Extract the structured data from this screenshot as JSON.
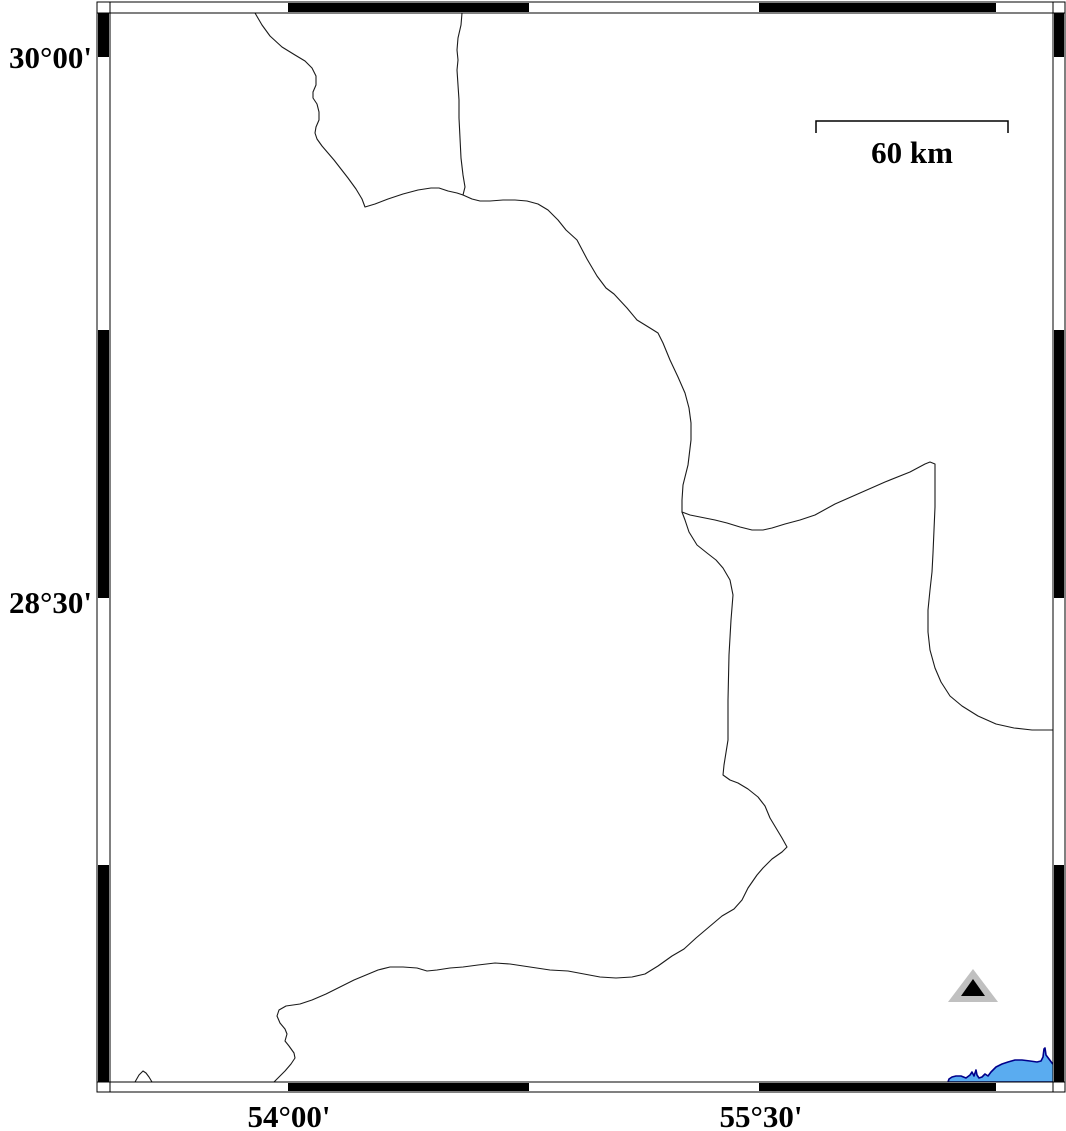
{
  "map": {
    "labels": {
      "lat": [
        {
          "text": "30°00'",
          "y_px": 57
        },
        {
          "text": "28°30'",
          "y_px": 602
        }
      ],
      "lon": [
        {
          "text": "54°00'",
          "x_px": 288
        },
        {
          "text": "55°30'",
          "x_px": 760
        }
      ]
    },
    "scalebar": {
      "label": "60 km",
      "x1": 816,
      "x2": 1008,
      "y": 121,
      "tick_drop": 12
    },
    "station_symbol": {
      "shape": "triangle",
      "outer": {
        "points": [
          [
            973,
            969
          ],
          [
            948,
            1002
          ],
          [
            998,
            1002
          ]
        ],
        "color": "#c0c0c0"
      },
      "inner": {
        "points": [
          [
            973,
            979
          ],
          [
            961,
            996
          ],
          [
            985,
            996
          ]
        ],
        "color": "#000000"
      }
    },
    "colors": {
      "boundary": "#1a1a1a",
      "lake_fill": "#5aacf0",
      "lake_stroke": "#00008b",
      "frame_black": "#000000",
      "frame_white": "#ffffff"
    },
    "frame": {
      "outer_x1": 97,
      "outer_x2": 1065,
      "outer_y1": 2,
      "outer_y2": 1092,
      "inner_x1": 110,
      "inner_x2": 1053,
      "inner_y1": 13,
      "inner_y2": 1082,
      "lon_black_segments_px": [
        [
          288,
          529
        ],
        [
          759,
          996
        ]
      ],
      "lat_black_segments_px": [
        [
          13,
          57
        ],
        [
          330,
          598
        ],
        [
          865,
          1082
        ]
      ]
    },
    "boundaries": [
      {
        "name": "northwest-zigzag-boundary",
        "points": [
          [
            255,
            13
          ],
          [
            262,
            25
          ],
          [
            270,
            36
          ],
          [
            282,
            47
          ],
          [
            295,
            55
          ],
          [
            305,
            61
          ],
          [
            312,
            68
          ],
          [
            316,
            76
          ],
          [
            316,
            85
          ],
          [
            313,
            92
          ],
          [
            313,
            98
          ],
          [
            317,
            104
          ],
          [
            319,
            112
          ],
          [
            319,
            120
          ],
          [
            316,
            127
          ],
          [
            315,
            133
          ],
          [
            317,
            139
          ],
          [
            322,
            146
          ],
          [
            328,
            153
          ],
          [
            334,
            160
          ],
          [
            341,
            169
          ],
          [
            348,
            178
          ],
          [
            356,
            189
          ],
          [
            362,
            199
          ],
          [
            365,
            207
          ],
          [
            375,
            204
          ],
          [
            388,
            199
          ],
          [
            403,
            194
          ],
          [
            418,
            190
          ],
          [
            431,
            188
          ],
          [
            439,
            188
          ],
          [
            448,
            191
          ],
          [
            457,
            193
          ],
          [
            463,
            195
          ]
        ]
      },
      {
        "name": "north-vertical-boundary",
        "points": [
          [
            462,
            13
          ],
          [
            461,
            25
          ],
          [
            458,
            38
          ],
          [
            457,
            50
          ],
          [
            458,
            60
          ],
          [
            457,
            70
          ],
          [
            458,
            85
          ],
          [
            459,
            100
          ],
          [
            459,
            118
          ],
          [
            460,
            138
          ],
          [
            461,
            158
          ],
          [
            463,
            175
          ],
          [
            465,
            187
          ],
          [
            463,
            195
          ]
        ]
      },
      {
        "name": "central-spine-boundary",
        "points": [
          [
            463,
            195
          ],
          [
            472,
            199
          ],
          [
            480,
            201
          ],
          [
            490,
            201
          ],
          [
            503,
            200
          ],
          [
            515,
            200
          ],
          [
            527,
            201
          ],
          [
            538,
            204
          ],
          [
            548,
            210
          ],
          [
            558,
            220
          ],
          [
            566,
            230
          ],
          [
            577,
            240
          ],
          [
            587,
            259
          ],
          [
            597,
            276
          ],
          [
            606,
            288
          ],
          [
            614,
            294
          ],
          [
            627,
            308
          ],
          [
            637,
            320
          ],
          [
            650,
            328
          ],
          [
            658,
            333
          ],
          [
            663,
            343
          ],
          [
            670,
            360
          ],
          [
            678,
            377
          ],
          [
            685,
            393
          ],
          [
            689,
            408
          ],
          [
            691,
            423
          ],
          [
            691,
            440
          ],
          [
            688,
            465
          ],
          [
            683,
            485
          ],
          [
            682,
            500
          ],
          [
            682,
            512
          ]
        ]
      },
      {
        "name": "east-boundary",
        "points": [
          [
            682,
            512
          ],
          [
            690,
            515
          ],
          [
            700,
            517
          ],
          [
            715,
            520
          ],
          [
            727,
            523
          ],
          [
            740,
            527
          ],
          [
            752,
            530
          ],
          [
            763,
            530
          ],
          [
            772,
            528
          ],
          [
            785,
            524
          ],
          [
            800,
            520
          ],
          [
            815,
            515
          ],
          [
            835,
            504
          ],
          [
            860,
            493
          ],
          [
            885,
            482
          ],
          [
            910,
            472
          ],
          [
            925,
            464
          ],
          [
            930,
            462
          ],
          [
            935,
            464
          ],
          [
            935,
            480
          ],
          [
            935,
            507
          ],
          [
            934,
            530
          ],
          [
            933,
            553
          ],
          [
            932,
            572
          ],
          [
            930,
            590
          ],
          [
            928,
            610
          ],
          [
            928,
            632
          ],
          [
            930,
            650
          ],
          [
            935,
            668
          ],
          [
            941,
            682
          ],
          [
            950,
            696
          ],
          [
            962,
            706
          ],
          [
            978,
            716
          ],
          [
            996,
            724
          ],
          [
            1014,
            728
          ],
          [
            1032,
            730
          ],
          [
            1045,
            730
          ],
          [
            1053,
            730
          ]
        ]
      },
      {
        "name": "south-boundary",
        "points": [
          [
            682,
            512
          ],
          [
            685,
            520
          ],
          [
            689,
            532
          ],
          [
            697,
            545
          ],
          [
            707,
            553
          ],
          [
            716,
            560
          ],
          [
            723,
            568
          ],
          [
            730,
            580
          ],
          [
            733,
            595
          ],
          [
            731,
            620
          ],
          [
            729,
            655
          ],
          [
            728,
            700
          ],
          [
            728,
            740
          ],
          [
            724,
            765
          ],
          [
            723,
            775
          ],
          [
            730,
            780
          ],
          [
            738,
            783
          ],
          [
            748,
            789
          ],
          [
            758,
            797
          ],
          [
            765,
            806
          ],
          [
            770,
            818
          ],
          [
            776,
            828
          ],
          [
            782,
            838
          ],
          [
            787,
            847
          ],
          [
            782,
            852
          ],
          [
            772,
            859
          ],
          [
            763,
            868
          ],
          [
            757,
            875
          ],
          [
            748,
            888
          ],
          [
            742,
            900
          ],
          [
            734,
            909
          ],
          [
            722,
            916
          ],
          [
            709,
            927
          ],
          [
            696,
            938
          ],
          [
            684,
            949
          ],
          [
            672,
            956
          ],
          [
            658,
            966
          ],
          [
            645,
            974
          ],
          [
            632,
            977
          ],
          [
            616,
            978
          ],
          [
            600,
            977
          ],
          [
            584,
            974
          ],
          [
            568,
            971
          ],
          [
            550,
            970
          ],
          [
            530,
            967
          ],
          [
            510,
            964
          ],
          [
            495,
            963
          ],
          [
            478,
            965
          ],
          [
            463,
            967
          ],
          [
            450,
            968
          ],
          [
            437,
            970
          ],
          [
            427,
            971
          ],
          [
            417,
            968
          ],
          [
            403,
            967
          ],
          [
            390,
            967
          ],
          [
            378,
            970
          ],
          [
            366,
            975
          ],
          [
            354,
            980
          ],
          [
            340,
            987
          ],
          [
            326,
            994
          ],
          [
            312,
            1000
          ],
          [
            300,
            1004
          ],
          [
            286,
            1006
          ],
          [
            279,
            1010
          ],
          [
            277,
            1016
          ],
          [
            280,
            1023
          ],
          [
            285,
            1029
          ],
          [
            287,
            1034
          ],
          [
            285,
            1041
          ],
          [
            289,
            1046
          ],
          [
            294,
            1053
          ],
          [
            295,
            1058
          ],
          [
            291,
            1064
          ],
          [
            285,
            1071
          ],
          [
            277,
            1079
          ],
          [
            274,
            1082
          ]
        ]
      },
      {
        "name": "small-bump-bottom-left",
        "points": [
          [
            135,
            1082
          ],
          [
            139,
            1075
          ],
          [
            143,
            1071
          ],
          [
            146,
            1073
          ],
          [
            149,
            1077
          ],
          [
            152,
            1082
          ]
        ]
      }
    ],
    "lake": {
      "name": "lake-bottom-right",
      "points": [
        [
          948,
          1082
        ],
        [
          949,
          1079
        ],
        [
          952,
          1077
        ],
        [
          956,
          1076
        ],
        [
          961,
          1076
        ],
        [
          966,
          1078
        ],
        [
          970,
          1075
        ],
        [
          972,
          1072
        ],
        [
          974,
          1076
        ],
        [
          976,
          1070
        ],
        [
          977,
          1075
        ],
        [
          979,
          1078
        ],
        [
          982,
          1077
        ],
        [
          985,
          1074
        ],
        [
          988,
          1076
        ],
        [
          991,
          1072
        ],
        [
          996,
          1067
        ],
        [
          1002,
          1064
        ],
        [
          1008,
          1062
        ],
        [
          1015,
          1060
        ],
        [
          1022,
          1060
        ],
        [
          1030,
          1061
        ],
        [
          1037,
          1062
        ],
        [
          1041,
          1061
        ],
        [
          1043,
          1057
        ],
        [
          1044,
          1049
        ],
        [
          1045,
          1048
        ],
        [
          1046,
          1055
        ],
        [
          1049,
          1059
        ],
        [
          1052,
          1063
        ],
        [
          1056,
          1067
        ],
        [
          1056,
          1082
        ]
      ]
    }
  }
}
